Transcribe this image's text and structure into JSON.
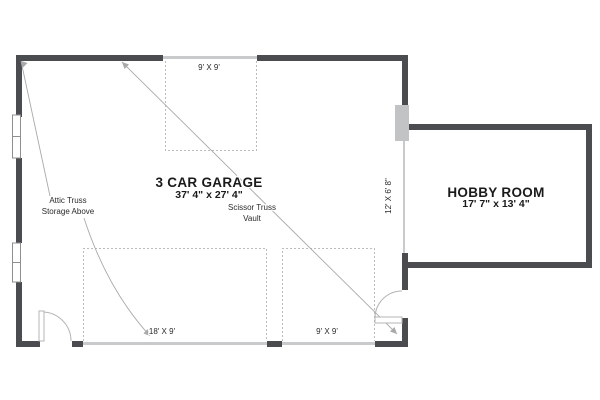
{
  "plan": {
    "garage": {
      "title": "3 CAR GARAGE",
      "dims": "37' 4\" x 27' 4\""
    },
    "hobby": {
      "title": "HOBBY ROOM",
      "dims": "17' 7\" x 13' 4\""
    },
    "openings": {
      "top_garage_door": "9' X 9'",
      "main_garage_door": "18' X 9'",
      "right_garage_door": "9' X 9'",
      "passage_opening": "12' X 6' 8\""
    },
    "notes": {
      "attic_line1": "Attic Truss",
      "attic_line2": "Storage Above",
      "scissor_line1": "Scissor Truss",
      "scissor_line2": "Vault"
    },
    "colors": {
      "wall": "#4a4c50",
      "door_panel": "#c9cacb",
      "dashed_line": "#bcbcbc",
      "leader_line": "#a9a9a9",
      "text": "#1a1a1a",
      "background": "#ffffff"
    }
  }
}
